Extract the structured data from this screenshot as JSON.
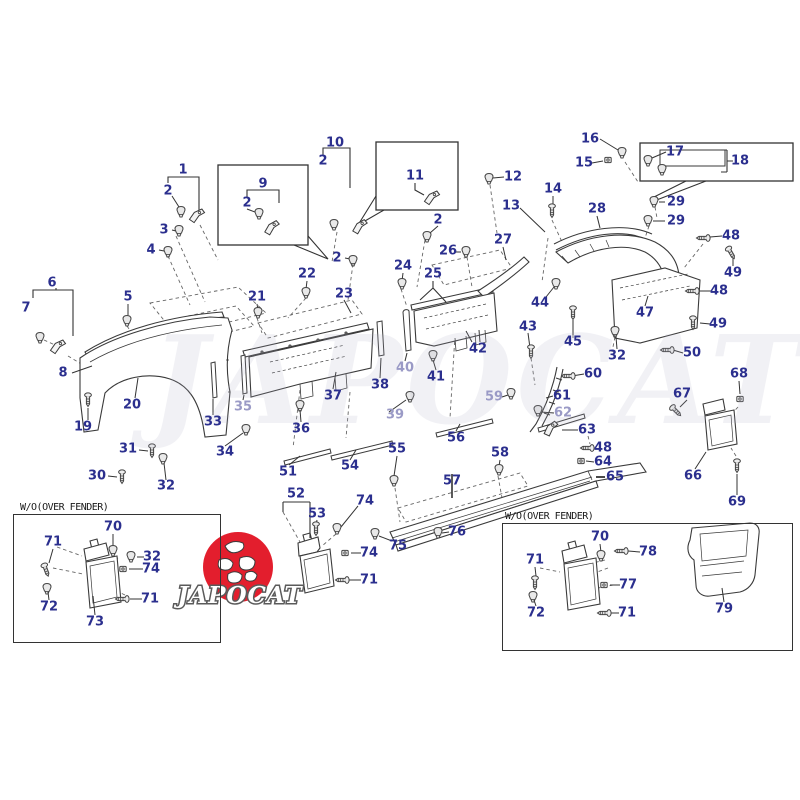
{
  "diagram": {
    "type": "exploded-parts-diagram",
    "subject": "vehicle body side moulding, fender flare and mudguard parts"
  },
  "watermark": {
    "text": "JAPOCAT"
  },
  "logo": {
    "text": "JAPOCAT",
    "circle_color": "#e31e2d"
  },
  "insets": {
    "left": {
      "title": "W/O(OVER FENDER)"
    },
    "right": {
      "title": "W/O(OVER FENDER)"
    }
  },
  "colors": {
    "label": "#2b2f8e",
    "label_faded": "#9a9ac6",
    "line": "#3a3a3a"
  },
  "labels": [
    {
      "t": "1",
      "x": 183,
      "y": 170
    },
    {
      "t": "2",
      "x": 168,
      "y": 191
    },
    {
      "t": "3",
      "x": 164,
      "y": 230
    },
    {
      "t": "4",
      "x": 151,
      "y": 250
    },
    {
      "t": "5",
      "x": 128,
      "y": 297
    },
    {
      "t": "6",
      "x": 52,
      "y": 283
    },
    {
      "t": "7",
      "x": 26,
      "y": 308
    },
    {
      "t": "8",
      "x": 63,
      "y": 373
    },
    {
      "t": "9",
      "x": 263,
      "y": 184
    },
    {
      "t": "2",
      "x": 247,
      "y": 203
    },
    {
      "t": "10",
      "x": 335,
      "y": 143
    },
    {
      "t": "2",
      "x": 323,
      "y": 161
    },
    {
      "t": "11",
      "x": 415,
      "y": 176
    },
    {
      "t": "12",
      "x": 513,
      "y": 177
    },
    {
      "t": "13",
      "x": 511,
      "y": 206
    },
    {
      "t": "2",
      "x": 438,
      "y": 220
    },
    {
      "t": "2",
      "x": 337,
      "y": 258
    },
    {
      "t": "14",
      "x": 553,
      "y": 189
    },
    {
      "t": "15",
      "x": 584,
      "y": 163
    },
    {
      "t": "16",
      "x": 590,
      "y": 139
    },
    {
      "t": "17",
      "x": 675,
      "y": 152
    },
    {
      "t": "18",
      "x": 740,
      "y": 161
    },
    {
      "t": "19",
      "x": 83,
      "y": 427
    },
    {
      "t": "20",
      "x": 132,
      "y": 405
    },
    {
      "t": "21",
      "x": 257,
      "y": 297
    },
    {
      "t": "22",
      "x": 307,
      "y": 274
    },
    {
      "t": "23",
      "x": 344,
      "y": 294
    },
    {
      "t": "24",
      "x": 403,
      "y": 266
    },
    {
      "t": "25",
      "x": 433,
      "y": 274
    },
    {
      "t": "26",
      "x": 448,
      "y": 251
    },
    {
      "t": "27",
      "x": 503,
      "y": 240
    },
    {
      "t": "28",
      "x": 597,
      "y": 209
    },
    {
      "t": "29",
      "x": 676,
      "y": 202
    },
    {
      "t": "29",
      "x": 676,
      "y": 221
    },
    {
      "t": "30",
      "x": 97,
      "y": 476
    },
    {
      "t": "31",
      "x": 128,
      "y": 449
    },
    {
      "t": "32",
      "x": 166,
      "y": 486
    },
    {
      "t": "32",
      "x": 617,
      "y": 356
    },
    {
      "t": "32",
      "x": 152,
      "y": 557
    },
    {
      "t": "33",
      "x": 213,
      "y": 422
    },
    {
      "t": "34",
      "x": 225,
      "y": 452
    },
    {
      "t": "35",
      "x": 243,
      "y": 407,
      "f": 1
    },
    {
      "t": "36",
      "x": 301,
      "y": 429
    },
    {
      "t": "37",
      "x": 333,
      "y": 396
    },
    {
      "t": "38",
      "x": 380,
      "y": 385
    },
    {
      "t": "39",
      "x": 395,
      "y": 415,
      "f": 1
    },
    {
      "t": "40",
      "x": 405,
      "y": 368,
      "f": 1
    },
    {
      "t": "41",
      "x": 436,
      "y": 377
    },
    {
      "t": "42",
      "x": 478,
      "y": 349
    },
    {
      "t": "43",
      "x": 528,
      "y": 327
    },
    {
      "t": "44",
      "x": 540,
      "y": 303
    },
    {
      "t": "45",
      "x": 573,
      "y": 342
    },
    {
      "t": "47",
      "x": 645,
      "y": 313
    },
    {
      "t": "48",
      "x": 731,
      "y": 236
    },
    {
      "t": "48",
      "x": 719,
      "y": 291
    },
    {
      "t": "48",
      "x": 603,
      "y": 448
    },
    {
      "t": "49",
      "x": 733,
      "y": 273
    },
    {
      "t": "49",
      "x": 718,
      "y": 324
    },
    {
      "t": "50",
      "x": 692,
      "y": 353
    },
    {
      "t": "51",
      "x": 288,
      "y": 472
    },
    {
      "t": "52",
      "x": 296,
      "y": 494
    },
    {
      "t": "53",
      "x": 317,
      "y": 514
    },
    {
      "t": "54",
      "x": 350,
      "y": 466
    },
    {
      "t": "55",
      "x": 397,
      "y": 449
    },
    {
      "t": "56",
      "x": 456,
      "y": 438
    },
    {
      "t": "57",
      "x": 452,
      "y": 481
    },
    {
      "t": "58",
      "x": 500,
      "y": 453
    },
    {
      "t": "59",
      "x": 494,
      "y": 397,
      "f": 1
    },
    {
      "t": "60",
      "x": 593,
      "y": 374
    },
    {
      "t": "61",
      "x": 562,
      "y": 396
    },
    {
      "t": "62",
      "x": 563,
      "y": 413,
      "f": 1
    },
    {
      "t": "63",
      "x": 587,
      "y": 430
    },
    {
      "t": "64",
      "x": 603,
      "y": 462
    },
    {
      "t": "65",
      "x": 615,
      "y": 477
    },
    {
      "t": "66",
      "x": 693,
      "y": 476
    },
    {
      "t": "67",
      "x": 682,
      "y": 394
    },
    {
      "t": "68",
      "x": 739,
      "y": 374
    },
    {
      "t": "69",
      "x": 737,
      "y": 502
    },
    {
      "t": "70",
      "x": 113,
      "y": 527
    },
    {
      "t": "70",
      "x": 600,
      "y": 537
    },
    {
      "t": "71",
      "x": 53,
      "y": 542
    },
    {
      "t": "71",
      "x": 150,
      "y": 599
    },
    {
      "t": "71",
      "x": 369,
      "y": 580
    },
    {
      "t": "71",
      "x": 535,
      "y": 560
    },
    {
      "t": "71",
      "x": 627,
      "y": 613
    },
    {
      "t": "72",
      "x": 49,
      "y": 607
    },
    {
      "t": "72",
      "x": 536,
      "y": 613
    },
    {
      "t": "73",
      "x": 95,
      "y": 622
    },
    {
      "t": "74",
      "x": 365,
      "y": 501
    },
    {
      "t": "74",
      "x": 369,
      "y": 553
    },
    {
      "t": "74",
      "x": 151,
      "y": 569
    },
    {
      "t": "75",
      "x": 398,
      "y": 546
    },
    {
      "t": "76",
      "x": 457,
      "y": 532
    },
    {
      "t": "77",
      "x": 628,
      "y": 585
    },
    {
      "t": "78",
      "x": 648,
      "y": 552
    },
    {
      "t": "79",
      "x": 724,
      "y": 609
    }
  ]
}
